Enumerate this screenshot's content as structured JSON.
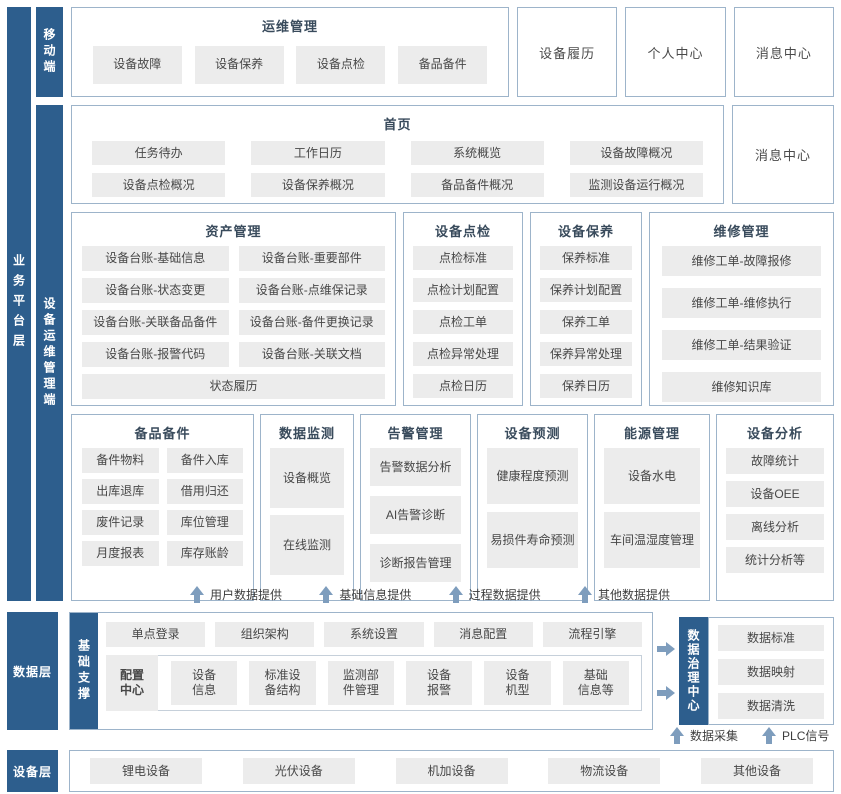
{
  "colors": {
    "accent_bar": "#2d5e8d",
    "arrow": "#7e9dbd",
    "box_border": "#9db4ca",
    "item_bg": "#ececec"
  },
  "layers": {
    "business": {
      "label": "业务平台层"
    },
    "mobile": {
      "label": "移动端",
      "ops": {
        "title": "运维管理",
        "items": [
          "设备故障",
          "设备保养",
          "设备点检",
          "备品备件"
        ]
      },
      "standalone": [
        "设备履历",
        "个人中心",
        "消息中心"
      ]
    },
    "device_mgmt": {
      "label": "设备运维管理端",
      "home": {
        "title": "首页",
        "items": [
          "任务待办",
          "工作日历",
          "系统概览",
          "设备故障概况",
          "设备点检概况",
          "设备保养概况",
          "备品备件概况",
          "监测设备运行概况"
        ]
      },
      "home_side": "消息中心",
      "asset": {
        "title": "资产管理",
        "items": [
          "设备台账-基础信息",
          "设备台账-重要部件",
          "设备台账-状态变更",
          "设备台账-点维保记录",
          "设备台账-关联备品备件",
          "设备台账-备件更换记录",
          "设备台账-报警代码",
          "设备台账-关联文档"
        ],
        "footer": "状态履历"
      },
      "inspection": {
        "title": "设备点检",
        "items": [
          "点检标准",
          "点检计划配置",
          "点检工单",
          "点检异常处理",
          "点检日历"
        ]
      },
      "maintenance": {
        "title": "设备保养",
        "items": [
          "保养标准",
          "保养计划配置",
          "保养工单",
          "保养异常处理",
          "保养日历"
        ]
      },
      "repair": {
        "title": "维修管理",
        "items": [
          "维修工单-故障报修",
          "维修工单-维修执行",
          "维修工单-结果验证",
          "维修知识库"
        ]
      },
      "spare": {
        "title": "备品备件",
        "items": [
          "备件物料",
          "备件入库",
          "出库退库",
          "借用归还",
          "废件记录",
          "库位管理",
          "月度报表",
          "库存账龄"
        ]
      },
      "monitor": {
        "title": "数据监测",
        "items": [
          "设备概览",
          "在线监测"
        ]
      },
      "alarm": {
        "title": "告警管理",
        "items": [
          "告警数据分析",
          "AI告警诊断",
          "诊断报告管理"
        ]
      },
      "predict": {
        "title": "设备预测",
        "items": [
          "健康程度预测",
          "易损件寿命预测"
        ]
      },
      "energy": {
        "title": "能源管理",
        "items": [
          "设备水电",
          "车间温湿度管理"
        ]
      },
      "analysis": {
        "title": "设备分析",
        "items": [
          "故障统计",
          "设备OEE",
          "离线分析",
          "统计分析等"
        ]
      }
    },
    "flow_up": [
      "用户数据提供",
      "基础信息提供",
      "过程数据提供",
      "其他数据提供"
    ],
    "data": {
      "label": "数据层",
      "support": {
        "label": "基础支撑",
        "row1": [
          "单点登录",
          "组织架构",
          "系统设置",
          "消息配置",
          "流程引擎"
        ],
        "config_label": "配置\n中心",
        "row2": [
          "设备\n信息",
          "标准设\n备结构",
          "监测部\n件管理",
          "设备\n报警",
          "设备\n机型",
          "基础\n信息等"
        ]
      },
      "governance": {
        "label": "数据治理中心",
        "items": [
          "数据标准",
          "数据映射",
          "数据清洗"
        ]
      },
      "flow_up": [
        "数据采集",
        "PLC信号"
      ]
    },
    "equipment": {
      "label": "设备层",
      "items": [
        "锂电设备",
        "光伏设备",
        "机加设备",
        "物流设备",
        "其他设备"
      ]
    }
  }
}
